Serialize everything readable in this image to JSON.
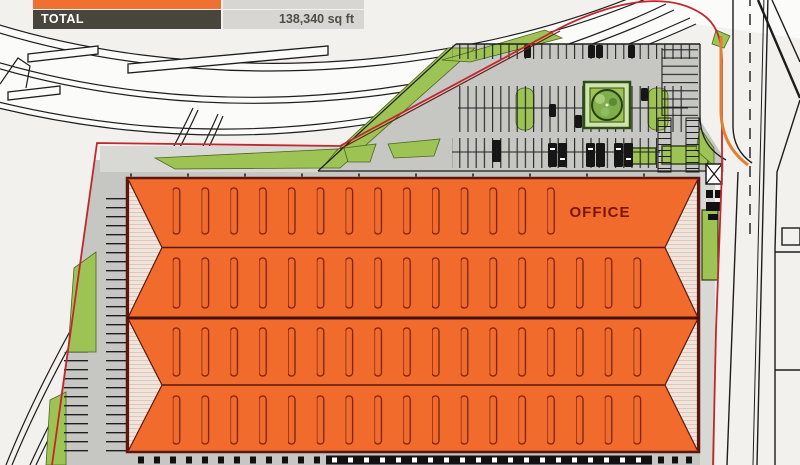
{
  "summary_table": {
    "clipped_row": {
      "note_color": "#f07031"
    },
    "total_row": {
      "label": "TOTAL",
      "value": "138,340 sq ft"
    }
  },
  "building": {
    "office_label": "OFFICE"
  },
  "colors": {
    "building_orange": "#f06b2c",
    "building_outline": "#5d1710",
    "gable_shading": "#efe5dd",
    "site_green": "#9dc355",
    "tree_green": "#7fae4a",
    "property_line_red": "#c2272d",
    "curb_orange": "#e08030",
    "pavement_gray": "#c6c6c3",
    "driveway_gray": "#d8d8d5",
    "road_white": "#fbfbf9",
    "table_header_bg": "#48453d",
    "table_value_bg": "#d7d6d2",
    "table_row_orange": "#f07031"
  }
}
